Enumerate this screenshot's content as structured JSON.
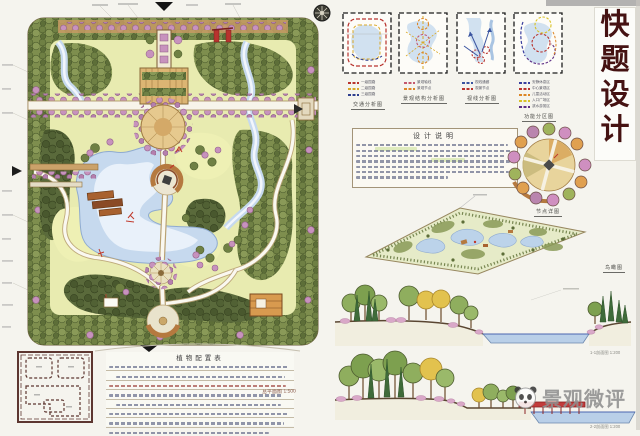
{
  "board": {
    "banner_chars": [
      "快",
      "题",
      "设",
      "计"
    ],
    "watermark_text": "景观微评"
  },
  "analysis_diagrams": [
    {
      "caption": "交通分析图",
      "legend": [
        [
          "#b8332e",
          "一级园路"
        ],
        [
          "#d9a826",
          "二级园路"
        ],
        [
          "#2e3f8f",
          "三级园路"
        ]
      ]
    },
    {
      "caption": "景观结构分析图",
      "legend": [
        [
          "#c4586e",
          "景观轴线"
        ],
        [
          "#dd8626",
          "景观节点"
        ]
      ]
    },
    {
      "caption": "视线分析图",
      "legend": [
        [
          "#3a54a0",
          "视线通廊"
        ],
        [
          "#b8332e",
          "观景节点"
        ]
      ]
    },
    {
      "caption": "功能分区图",
      "legend": [
        [
          "#3a3f9e",
          "安静休息区"
        ],
        [
          "#b8332e",
          "中心景观区"
        ],
        [
          "#dd8626",
          "儿童活动区"
        ],
        [
          "#d9c226",
          "入口广场区"
        ],
        [
          "#5e2f86",
          "滨水游赏区"
        ]
      ]
    }
  ],
  "design_notes": {
    "title": "设计说明"
  },
  "plant_list": {
    "title": "植物配置表"
  },
  "captions": {
    "node_detail": "节点详图",
    "aerial": "鸟瞰图",
    "section_1": "1-1剖面图 1:200",
    "section_2": "2-2剖面图 1:200",
    "plan_scale": "总平面图 1:500"
  }
}
